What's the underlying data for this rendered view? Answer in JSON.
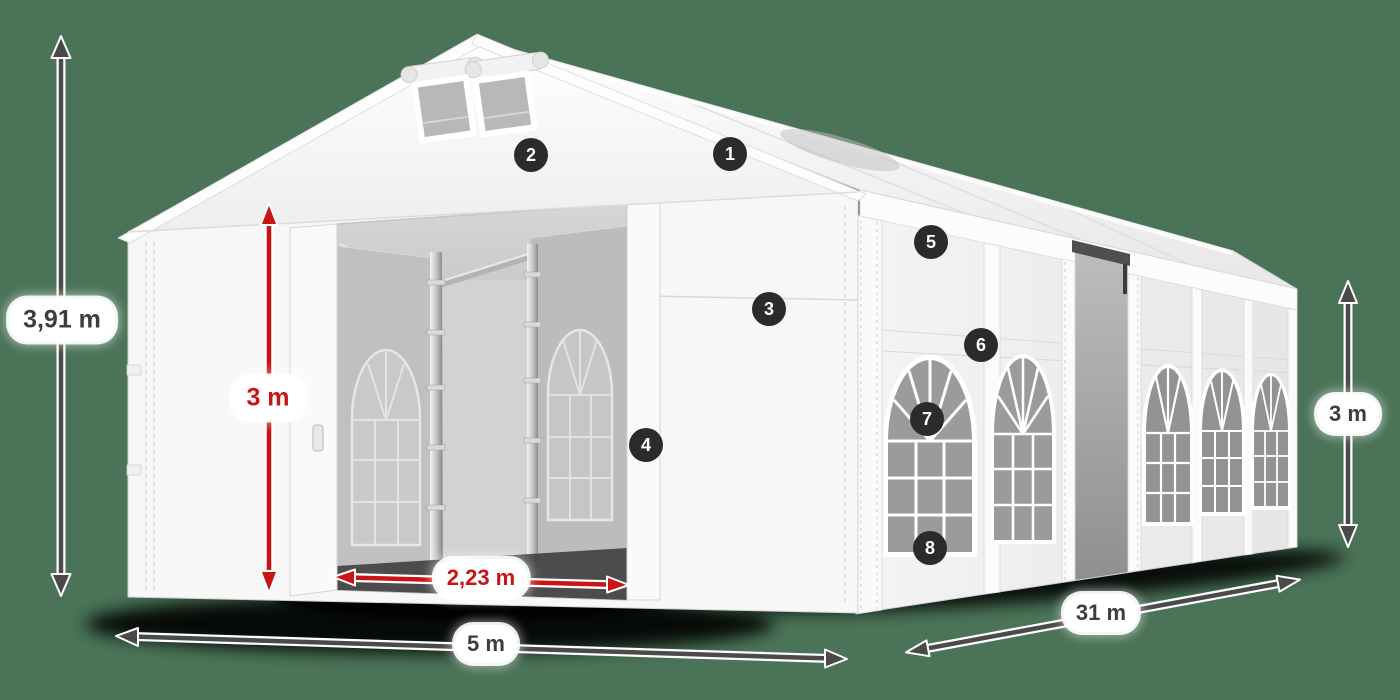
{
  "scene": {
    "type": "product-dimension-diagram",
    "subject": "white marquee storage tent shown in perspective with dimension arrows and numbered part markers",
    "background_color": "#4a7357"
  },
  "dimensions": {
    "total_height": {
      "label": "3,91 m",
      "style": "dark"
    },
    "inner_height": {
      "label": "3 m",
      "style": "red"
    },
    "door_width": {
      "label": "2,23 m",
      "style": "red"
    },
    "front_width": {
      "label": "5 m",
      "style": "dark"
    },
    "side_length": {
      "label": "31 m",
      "style": "dark"
    },
    "side_height": {
      "label": "3 m",
      "style": "dark"
    }
  },
  "badges": [
    {
      "number": "1"
    },
    {
      "number": "2"
    },
    {
      "number": "3"
    },
    {
      "number": "4"
    },
    {
      "number": "5"
    },
    {
      "number": "6"
    },
    {
      "number": "7"
    },
    {
      "number": "8"
    }
  ],
  "colors": {
    "dimension_arrow_dark": "#4a4a4a",
    "dimension_arrow_red": "#c81414",
    "dimension_label_background": "#ffffff",
    "dimension_label_text_dark": "#3d3d3d",
    "dimension_label_text_red": "#c81414",
    "badge_background": "#2b2b2b",
    "badge_text": "#ffffff",
    "tent_white": "#f7f7f7",
    "interior_gray": "#b5b5b5",
    "window_glass_gray": "#9b9b9b"
  }
}
